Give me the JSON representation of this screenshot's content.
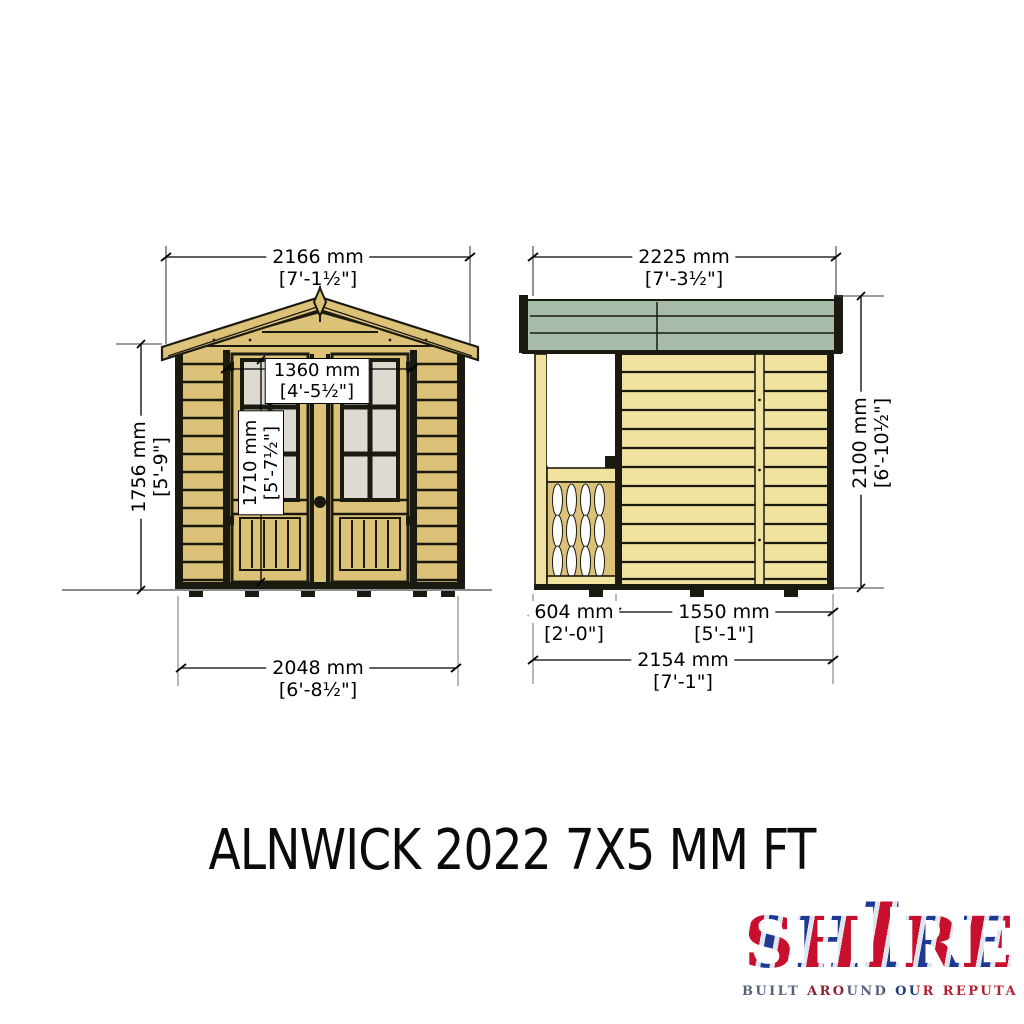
{
  "title": "ALNWICK 2022 7X5 MM FT",
  "front_elevation": {
    "dims": {
      "width_top": {
        "mm": "2166 mm",
        "ft": "[7'-1½\"]"
      },
      "door_width": {
        "mm": "1360 mm",
        "ft": "[4'-5½\"]"
      },
      "door_height": {
        "mm": "1710 mm",
        "ft": "[5'-7½\"]"
      },
      "wall_height": {
        "mm": "1756 mm",
        "ft": "[5'-9\"]"
      },
      "base_width": {
        "mm": "2048 mm",
        "ft": "[6'-8½\"]"
      }
    }
  },
  "side_elevation": {
    "dims": {
      "width_top": {
        "mm": "2225 mm",
        "ft": "[7'-3½\"]"
      },
      "height": {
        "mm": "2100 mm",
        "ft": "[6'-10½\"]"
      },
      "veranda_depth": {
        "mm": "604 mm",
        "ft": "[2'-0\"]"
      },
      "wall_depth": {
        "mm": "1550 mm",
        "ft": "[5'-1\"]"
      },
      "base_width": {
        "mm": "2154 mm",
        "ft": "[7'-1\"]"
      }
    }
  },
  "logo": {
    "letters": [
      "S",
      "H",
      "I",
      "R",
      "E"
    ],
    "tagline": "BUILT AROUND OUR REPUTATION",
    "colors": {
      "navy": "#1f3a93",
      "red": "#c8102e",
      "silver": "#dfe6ef"
    }
  },
  "colors": {
    "wood": "#dcc179",
    "wood_pale": "#f2e2a0",
    "roof_felt": "#a7bbab",
    "glass": "#dedad1",
    "outline": "#1a1a10"
  }
}
